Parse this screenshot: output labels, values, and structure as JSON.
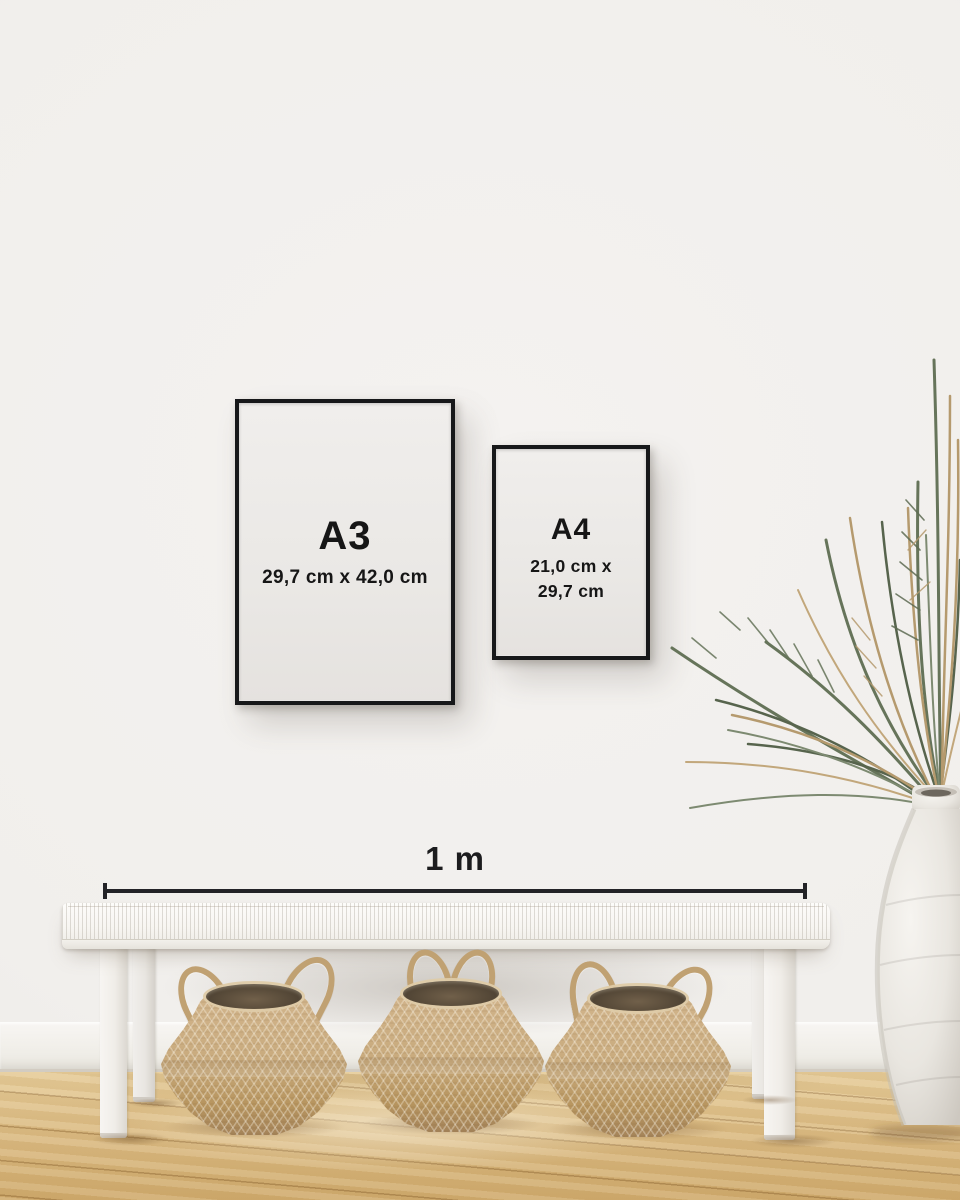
{
  "frames": {
    "a3": {
      "label": "A3",
      "size": "29,7 cm x 42,0 cm"
    },
    "a4": {
      "label": "A4",
      "size_line1": "21,0 cm x",
      "size_line2": "29,7 cm"
    }
  },
  "scale_bar": {
    "label": "1 m"
  },
  "colors": {
    "frame": "#17181a",
    "text": "#161616",
    "wall": "#f1efec",
    "baseboard": "#f5f3ef",
    "floor_wood": "#d9b983",
    "bench": "#faf8f5",
    "basket": "#c6a87c",
    "basket_interior": "#584a38",
    "vase": "#efece7",
    "plant_green": "#66745a",
    "plant_dried": "#b59a6e"
  }
}
